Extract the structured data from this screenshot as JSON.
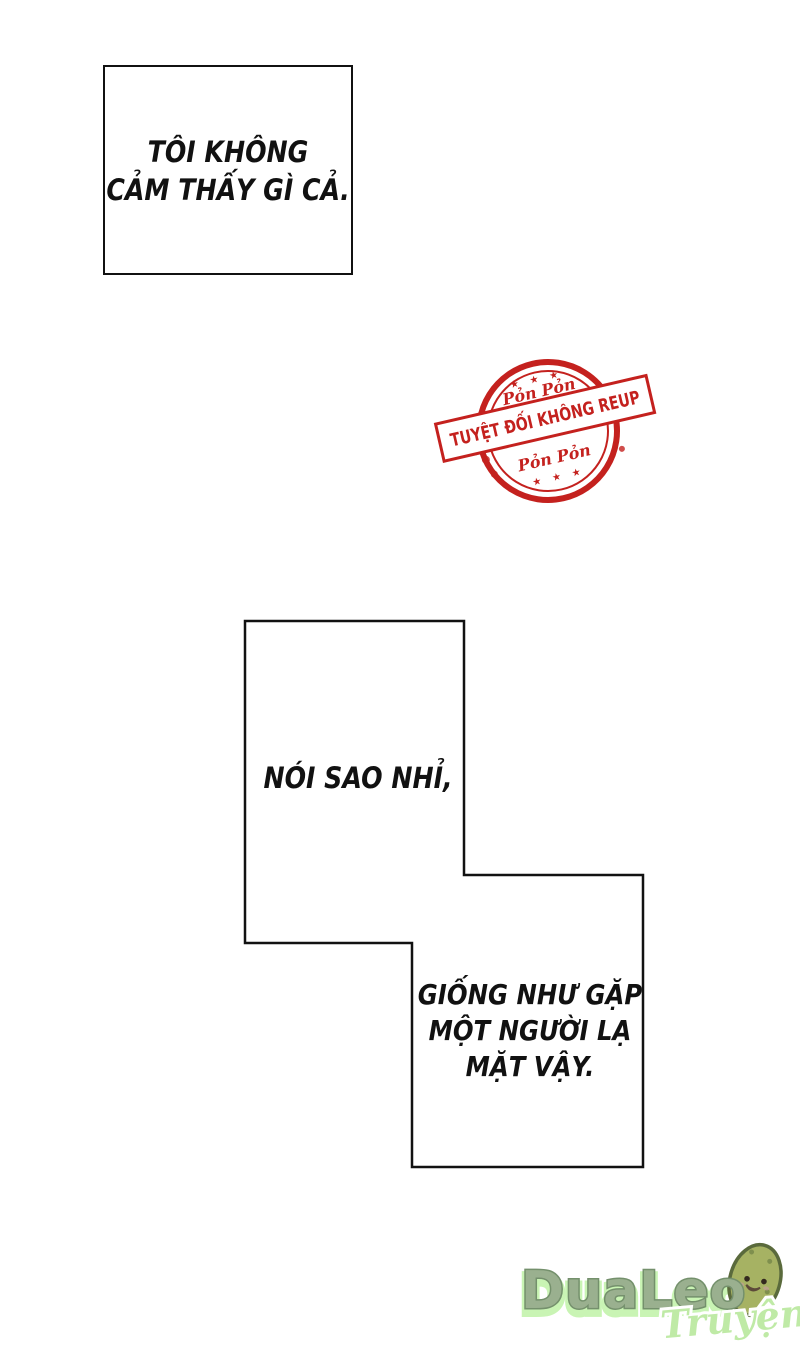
{
  "page": {
    "background_color": "#ffffff",
    "ink_color": "#111111"
  },
  "panels": {
    "panel1": {
      "line1": "TÔI KHÔNG",
      "line2": "CẢM THẤY GÌ CẢ."
    },
    "panel2": {
      "text": "NÓI SAO NHỈ,"
    },
    "panel3": {
      "line1": "GIỐNG NHƯ GẶP",
      "line2": "MỘT NGƯỜI LẠ",
      "line3": "MẶT VẬY."
    }
  },
  "stamp": {
    "banner_text": "TUYỆT ĐỐI KHÔNG REUP",
    "arc_top_text": "Pỏn Pỏn",
    "arc_bottom_text": "Pỏn Pỏn",
    "stars_top": "★ ★ ★",
    "stars_bottom": "★ ★ ★",
    "color": "#c4211e"
  },
  "logo": {
    "wordmark": "DuaLeo",
    "script": "Truyện",
    "wordmark_color": "#9ab08f",
    "wordmark_outline_color": "#74906c",
    "halo_color": "#c9f4b4",
    "script_color": "#bfeaa6",
    "cucumber_body_color": "#a6b263",
    "cucumber_outline_color": "#5a6a3c"
  }
}
